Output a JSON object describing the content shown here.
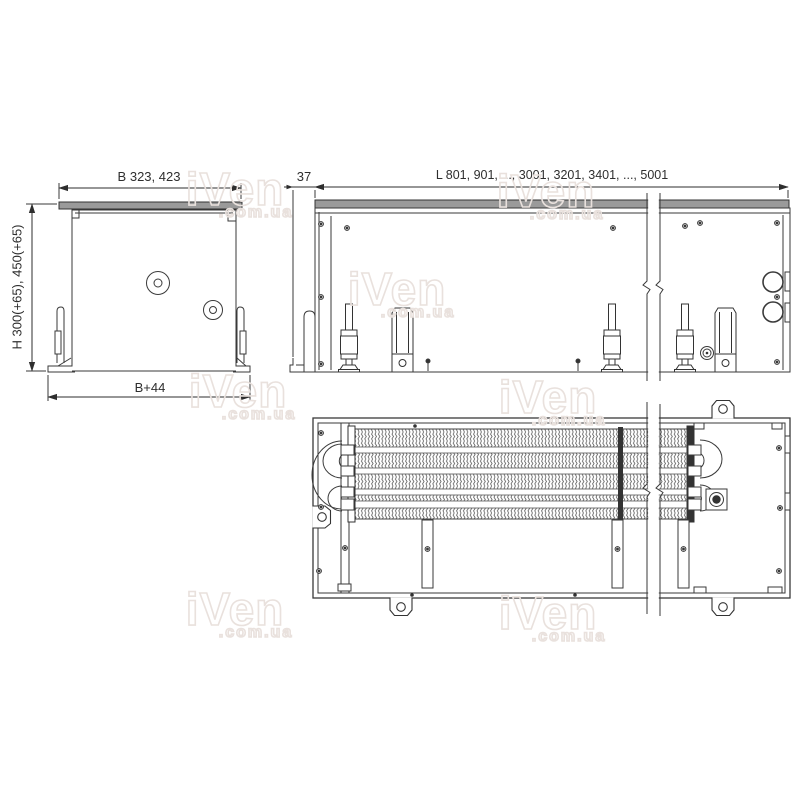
{
  "page": {
    "background": "#ffffff"
  },
  "drawing": {
    "type": "technical drawing - floor trench heating convector, three orthographic views",
    "line_color": "#3a3a3a",
    "lid_fill": "#9a9a9a",
    "views": {
      "end_view": {
        "name": "end view",
        "dim_width_label": "B 323, 423",
        "dim_height_label": "H 300(+65), 450(+65)",
        "dim_base_label": "B+44"
      },
      "side_view": {
        "name": "side view",
        "dim_overhang_label": "37",
        "dim_length_label": "L 801, 901, ..., 3001, 3201, 3401, ..., 5001"
      },
      "plan_view": {
        "name": "plan view"
      }
    },
    "watermark": {
      "brand": "iVen",
      "suffix": ".com.ua",
      "color": "#e9e1dd"
    }
  }
}
